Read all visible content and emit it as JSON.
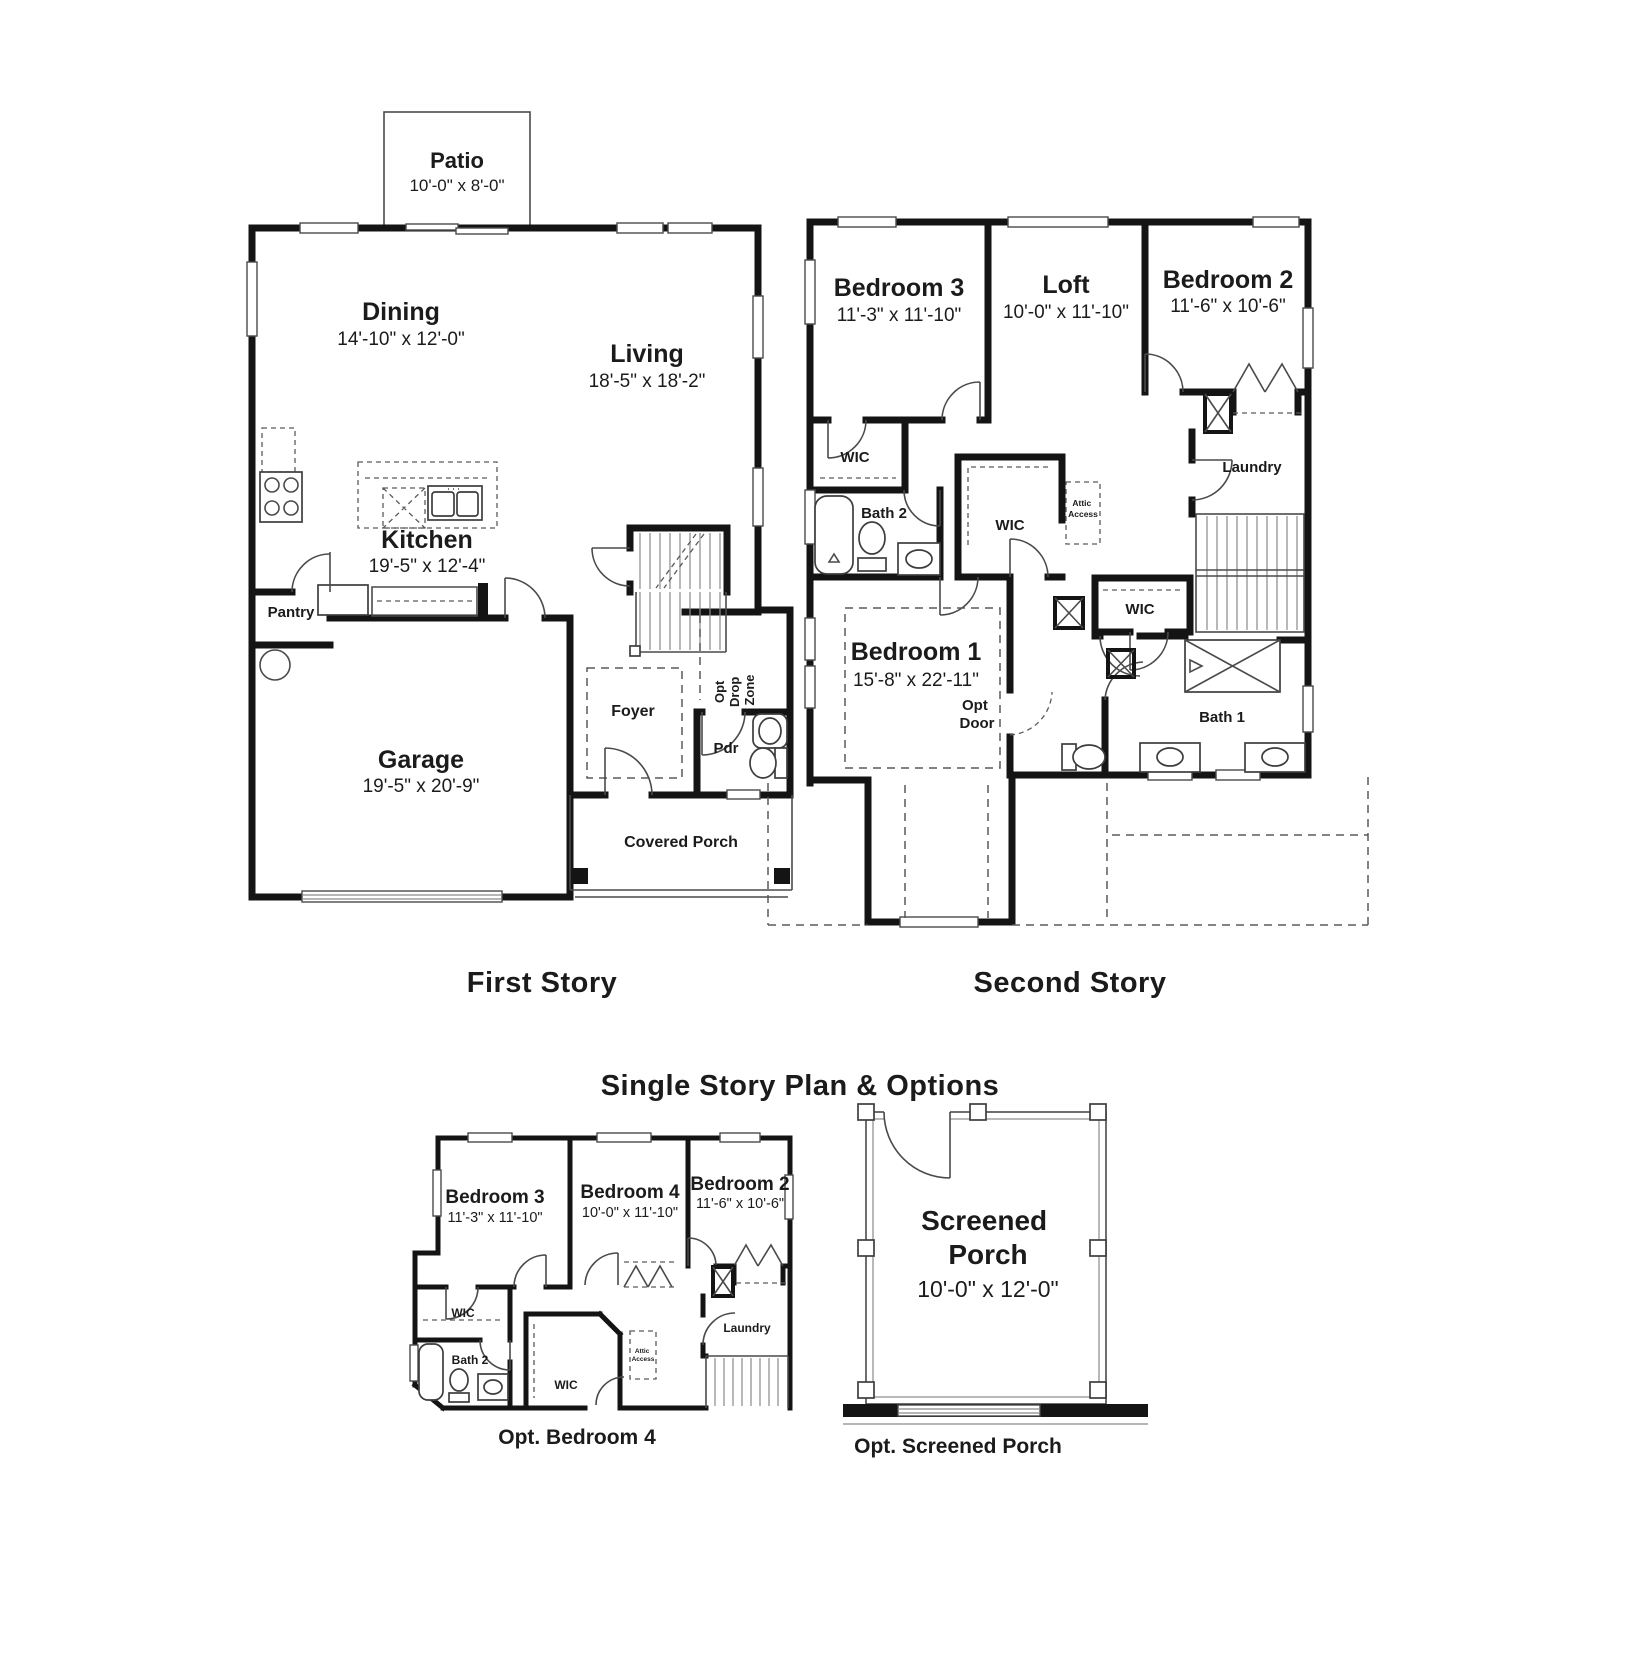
{
  "titles": {
    "first_story": "First Story",
    "second_story": "Second Story",
    "options": "Single Story Plan & Options",
    "opt_bedroom4": "Opt. Bedroom 4",
    "opt_screened_porch": "Opt. Screened Porch"
  },
  "first_story": {
    "patio": {
      "name": "Patio",
      "dims": "10'-0\" x 8'-0\""
    },
    "dining": {
      "name": "Dining",
      "dims": "14'-10\" x 12'-0\""
    },
    "living": {
      "name": "Living",
      "dims": "18'-5\" x 18'-2\""
    },
    "kitchen": {
      "name": "Kitchen",
      "dims": "19'-5\" x 12'-4\""
    },
    "pantry": {
      "name": "Pantry"
    },
    "garage": {
      "name": "Garage",
      "dims": "19'-5\" x 20'-9\""
    },
    "foyer": {
      "name": "Foyer"
    },
    "pdr": {
      "name": "Pdr"
    },
    "drop_zone": {
      "line1": "Opt",
      "line2": "Drop",
      "line3": "Zone"
    },
    "covered_porch": {
      "name": "Covered Porch"
    }
  },
  "second_story": {
    "bedroom3": {
      "name": "Bedroom 3",
      "dims": "11'-3\" x 11'-10\""
    },
    "loft": {
      "name": "Loft",
      "dims": "10'-0\" x 11'-10\""
    },
    "bedroom2": {
      "name": "Bedroom 2",
      "dims": "11'-6\" x 10'-6\""
    },
    "wic_b3": {
      "name": "WIC"
    },
    "bath2": {
      "name": "Bath 2"
    },
    "wic_center": {
      "name": "WIC"
    },
    "attic": {
      "line1": "Attic",
      "line2": "Access"
    },
    "laundry": {
      "name": "Laundry"
    },
    "wic_b1": {
      "name": "WIC"
    },
    "bedroom1": {
      "name": "Bedroom 1",
      "dims": "15'-8\" x 22'-11\""
    },
    "opt_door": {
      "line1": "Opt",
      "line2": "Door"
    },
    "bath1": {
      "name": "Bath 1"
    }
  },
  "opt_bedroom4_plan": {
    "bedroom3": {
      "name": "Bedroom 3",
      "dims": "11'-3\" x 11'-10\""
    },
    "bedroom4": {
      "name": "Bedroom 4",
      "dims": "10'-0\" x 11'-10\""
    },
    "bedroom2": {
      "name": "Bedroom 2",
      "dims": "11'-6\" x 10'-6\""
    },
    "wic_left": {
      "name": "WIC"
    },
    "bath2": {
      "name": "Bath 2"
    },
    "wic_center": {
      "name": "WIC"
    },
    "attic": {
      "line1": "Attic",
      "line2": "Access"
    },
    "laundry": {
      "name": "Laundry"
    }
  },
  "screened_porch_plan": {
    "name_line1": "Screened",
    "name_line2": "Porch",
    "dims": "10'-0\" x 12'-0\""
  }
}
